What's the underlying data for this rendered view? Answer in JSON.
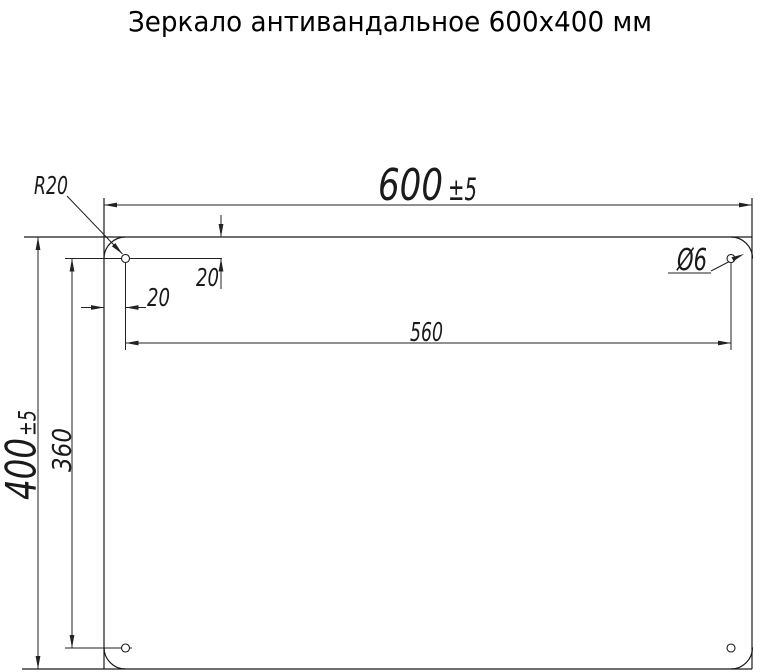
{
  "title": "Зеркало антивандальное 600х400 мм",
  "dimensions": {
    "width": {
      "value": "600",
      "tolerance": "±5"
    },
    "height": {
      "value": "400",
      "tolerance": "±5"
    },
    "hole_spacing_horizontal": "560",
    "hole_spacing_vertical": "360",
    "hole_offset_from_left": "20",
    "hole_offset_from_top": "20",
    "corner_radius": "R20",
    "hole_diameter": "Ø6"
  }
}
